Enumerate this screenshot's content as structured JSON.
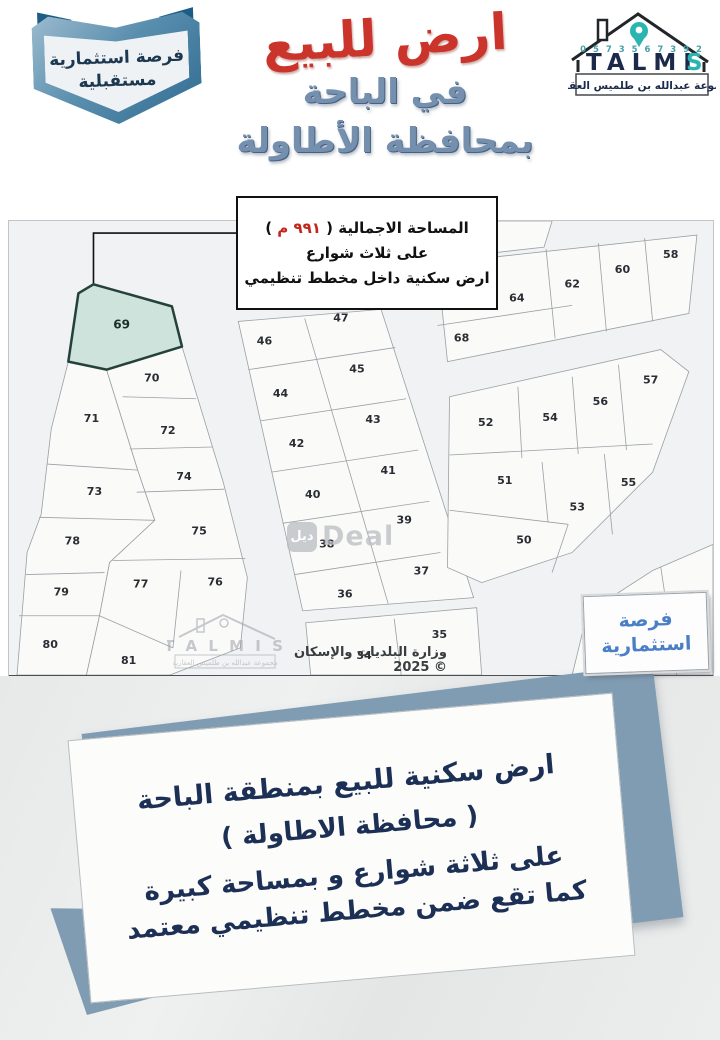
{
  "header": {
    "ribbon": {
      "line1": "فرصة استثمارية",
      "line2": "مستقبلية"
    },
    "title": {
      "line1": "ارض للبيع",
      "line2": "في الباحة",
      "line3": "بمحافظة الأطاولة",
      "red": "#cb342a",
      "blue": "#7590af"
    },
    "logo": {
      "phone": "0 5 7 3 5 6 7 3 9 2",
      "name_main": "TALMI",
      "name_last": "S",
      "tagline": "مجموعة عبدالله بن طلميس العقارية",
      "pin_color": "#2ab5b0"
    }
  },
  "info_box": {
    "line1_prefix": "المساحة الاجمالية",
    "paren_open": " ( ",
    "area_value": "٩٩١ م",
    "paren_close": " ) ",
    "line2": "على ثلاث شوارع",
    "line3": "ارض سكنية داخل مخطط تنظيمي"
  },
  "map": {
    "width": 700,
    "height": 452,
    "ministry_credit": "وزارة البلديات والإسكان © 2025",
    "deal_watermark": {
      "square": "ديل",
      "word": "Deal"
    },
    "talmis_watermark": {
      "name": "T A L M I S",
      "tagline": "مجموعة عبدالله بن طلميس العقارية"
    },
    "badge": {
      "line1": "فرصة",
      "line2": "استثمارية"
    },
    "highlight": {
      "label": "69",
      "label_pos": [
        112,
        107
      ],
      "points": [
        [
          84,
          63
        ],
        [
          162,
          85
        ],
        [
          172,
          125
        ],
        [
          97,
          148
        ],
        [
          59,
          140
        ],
        [
          69,
          72
        ]
      ]
    },
    "callout": [
      [
        228,
        12
      ],
      [
        84,
        12
      ],
      [
        84,
        63
      ]
    ],
    "blocks": [
      {
        "outline": [
          [
            59,
            140
          ],
          [
            97,
            148
          ],
          [
            128,
            248
          ],
          [
            145,
            298
          ],
          [
            100,
            340
          ],
          [
            90,
            393
          ],
          [
            77,
            452
          ],
          [
            8,
            452
          ],
          [
            18,
            330
          ],
          [
            32,
            292
          ],
          [
            42,
            207
          ]
        ],
        "dividers": [
          [
            38,
            242,
            128,
            248
          ],
          [
            30,
            295,
            145,
            298
          ],
          [
            17,
            352,
            95,
            350
          ],
          [
            10,
            393,
            90,
            393
          ]
        ]
      },
      {
        "outline": [
          [
            97,
            148
          ],
          [
            172,
            125
          ],
          [
            213,
            260
          ],
          [
            237,
            355
          ],
          [
            230,
            425
          ],
          [
            160,
            452
          ],
          [
            77,
            452
          ],
          [
            90,
            393
          ],
          [
            100,
            340
          ],
          [
            145,
            298
          ],
          [
            128,
            248
          ]
        ],
        "dividers": [
          [
            113,
            175,
            186,
            177
          ],
          [
            120,
            227,
            202,
            225
          ],
          [
            127,
            270,
            214,
            267
          ],
          [
            103,
            338,
            235,
            336
          ],
          [
            171,
            348,
            163,
            425
          ],
          [
            90,
            393,
            163,
            425
          ]
        ]
      },
      {
        "outline": [
          [
            228,
            100
          ],
          [
            370,
            88
          ],
          [
            462,
            375
          ],
          [
            292,
            388
          ]
        ],
        "dividers": [
          [
            294,
            97,
            377,
            381
          ],
          [
            238,
            148,
            384,
            126
          ],
          [
            250,
            199,
            395,
            177
          ],
          [
            261,
            250,
            407,
            228
          ],
          [
            272,
            301,
            418,
            279
          ],
          [
            284,
            352,
            429,
            330
          ]
        ]
      },
      {
        "outline": [
          [
            295,
            400
          ],
          [
            465,
            385
          ],
          [
            470,
            452
          ],
          [
            300,
            452
          ]
        ],
        "dividers": [
          [
            383,
            396,
            390,
            452
          ]
        ]
      },
      {
        "outline": [
          [
            428,
            0
          ],
          [
            540,
            0
          ],
          [
            532,
            26
          ],
          [
            426,
            38
          ]
        ],
        "dividers": []
      },
      {
        "outline": [
          [
            426,
            42
          ],
          [
            684,
            14
          ],
          [
            676,
            92
          ],
          [
            436,
            140
          ]
        ],
        "dividers": [
          [
            534,
            28,
            543,
            117
          ],
          [
            586,
            22,
            594,
            110
          ],
          [
            632,
            17,
            640,
            100
          ],
          [
            426,
            104,
            560,
            84
          ]
        ]
      },
      {
        "outline": [
          [
            438,
            175
          ],
          [
            648,
            128
          ],
          [
            676,
            150
          ],
          [
            640,
            250
          ],
          [
            560,
            330
          ],
          [
            470,
            360
          ],
          [
            436,
            345
          ]
        ],
        "dividers": [
          [
            438,
            233,
            640,
            222
          ],
          [
            506,
            165,
            510,
            236
          ],
          [
            560,
            155,
            566,
            232
          ],
          [
            606,
            143,
            614,
            228
          ],
          [
            530,
            240,
            536,
            300
          ],
          [
            438,
            288,
            556,
            302
          ],
          [
            592,
            232,
            600,
            312
          ],
          [
            556,
            302,
            540,
            350
          ]
        ]
      },
      {
        "outline": [
          [
            560,
            452
          ],
          [
            575,
            390
          ],
          [
            640,
            348
          ],
          [
            700,
            322
          ],
          [
            700,
            452
          ]
        ],
        "dividers": [
          [
            648,
            344,
            664,
            452
          ]
        ]
      }
    ],
    "labels": [
      {
        "n": "70",
        "x": 142,
        "y": 160
      },
      {
        "n": "71",
        "x": 82,
        "y": 200
      },
      {
        "n": "72",
        "x": 158,
        "y": 212
      },
      {
        "n": "73",
        "x": 85,
        "y": 273
      },
      {
        "n": "74",
        "x": 174,
        "y": 258
      },
      {
        "n": "75",
        "x": 189,
        "y": 312
      },
      {
        "n": "76",
        "x": 205,
        "y": 363
      },
      {
        "n": "77",
        "x": 131,
        "y": 365
      },
      {
        "n": "78",
        "x": 63,
        "y": 322
      },
      {
        "n": "79",
        "x": 52,
        "y": 373
      },
      {
        "n": "80",
        "x": 41,
        "y": 425
      },
      {
        "n": "81",
        "x": 119,
        "y": 441
      },
      {
        "n": "46",
        "x": 254,
        "y": 123
      },
      {
        "n": "47",
        "x": 330,
        "y": 100
      },
      {
        "n": "44",
        "x": 270,
        "y": 175
      },
      {
        "n": "45",
        "x": 346,
        "y": 151
      },
      {
        "n": "42",
        "x": 286,
        "y": 225
      },
      {
        "n": "43",
        "x": 362,
        "y": 201
      },
      {
        "n": "40",
        "x": 302,
        "y": 276
      },
      {
        "n": "41",
        "x": 377,
        "y": 252
      },
      {
        "n": "38",
        "x": 316,
        "y": 325
      },
      {
        "n": "39",
        "x": 393,
        "y": 301
      },
      {
        "n": "36",
        "x": 334,
        "y": 375
      },
      {
        "n": "37",
        "x": 410,
        "y": 352
      },
      {
        "n": "34",
        "x": 353,
        "y": 436
      },
      {
        "n": "35",
        "x": 428,
        "y": 415
      },
      {
        "n": "65",
        "x": 478,
        "y": 16
      },
      {
        "n": "64",
        "x": 505,
        "y": 80
      },
      {
        "n": "62",
        "x": 560,
        "y": 66
      },
      {
        "n": "60",
        "x": 610,
        "y": 52
      },
      {
        "n": "58",
        "x": 658,
        "y": 37
      },
      {
        "n": "68",
        "x": 450,
        "y": 120
      },
      {
        "n": "52",
        "x": 474,
        "y": 204
      },
      {
        "n": "54",
        "x": 538,
        "y": 199
      },
      {
        "n": "56",
        "x": 588,
        "y": 183
      },
      {
        "n": "57",
        "x": 638,
        "y": 162
      },
      {
        "n": "51",
        "x": 493,
        "y": 262
      },
      {
        "n": "53",
        "x": 565,
        "y": 288
      },
      {
        "n": "55",
        "x": 616,
        "y": 264
      },
      {
        "n": "50",
        "x": 512,
        "y": 321
      },
      {
        "n": "22",
        "x": 683,
        "y": 377
      },
      {
        "n": "20",
        "x": 578,
        "y": 408
      }
    ]
  },
  "bottom_card": {
    "line1": "ارض سكنية للبيع بمنطقة الباحة",
    "line2": "( محافظة الاطاولة )",
    "line3": "على ثلاثة شوارع و بمساحة كبيرة",
    "line4": "كما تقع ضمن مخطط تنظيمي معتمد"
  }
}
